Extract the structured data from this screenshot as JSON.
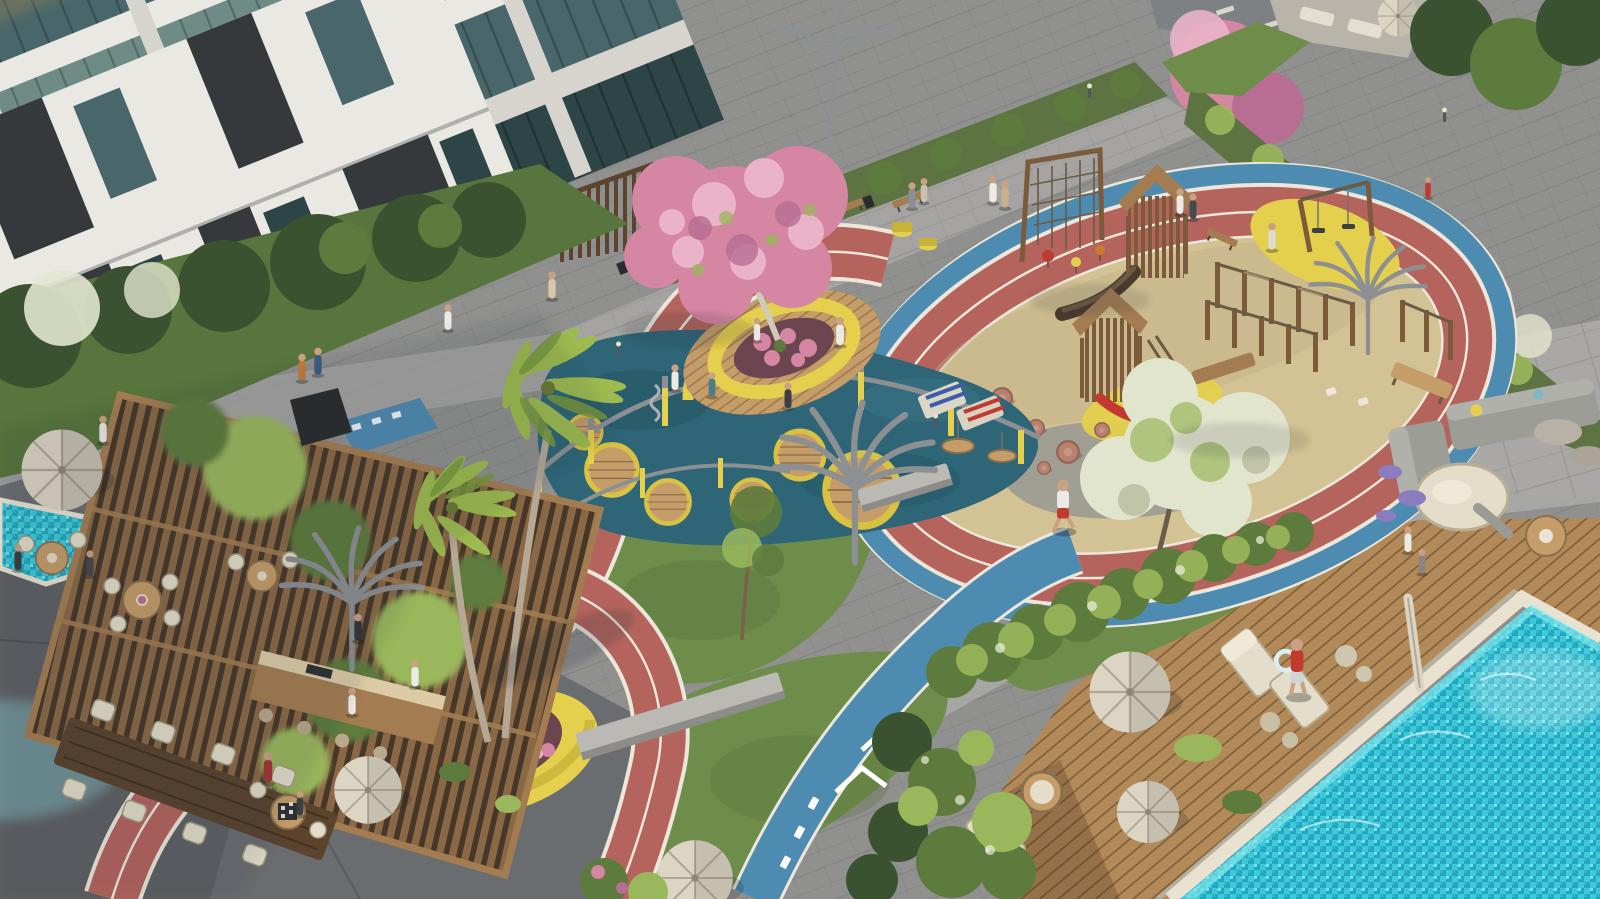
{
  "scene": {
    "type": "photorealistic aerial 3D architectural render",
    "setting": "Residential apartment courtyard amenity deck, daytime",
    "areas": {
      "building_left": "Glass-fronted apartment building at left",
      "building_center": "Apartment building with dark panels at top",
      "building_right": "Apartment building with balconies at right",
      "running_track": "Red two-lane jogging loop with white lane lines",
      "bike_path": "Blue cycle path with white chevrons and dashes",
      "playground_sand": "Sand play area inside the track loop",
      "play_towers": "Wooden play towers with slides",
      "climbing_frames": "Wooden climbing frames and monkey bars",
      "rubber_playground": "Teal rubber play surface with yellow posts, wooden discs and basket swings",
      "blossom_planter": "Round yellow planter with pink blossom tree on timber deck",
      "palm_planter": "Round yellow planter with pink flowers and palm trees",
      "pergola": "Timber pergola with climbing vines",
      "outdoor_kitchen": "Outdoor kitchen bar with stools",
      "cafe_terrace": "Cafe terrace with tables, chairs and parasols",
      "chess_table": "Outdoor chess table",
      "long_table": "Communal timber dining table",
      "swimming_pool": "Turquoise mosaic swimming pool",
      "pool_deck": "Timber pool deck with parasols, loungers and egg chair",
      "lounge_terrace": "Stone lounge terrace with grey sofas and round daybed",
      "shade_structures": "Steel palm-shaped shade structures",
      "walkways": "Grey paver walkways with benches and bollard lights",
      "small_pool": "Water feature at left edge",
      "road": "Street glimpse at top right",
      "breezeway": "Passage under left building with red jogging strip",
      "people": "Residents walking, jogging, playing and relaxing"
    }
  },
  "colors": {
    "paver_light": "#a9a8a6",
    "paver_mid": "#90908f",
    "paver_dark": "#717274",
    "concrete_terrace": "#6a6d70",
    "concrete_shadow": "#53565a",
    "facade_white": "#eae8e3",
    "facade_cream": "#d7d4cd",
    "facade_shadow": "#b7b4ad",
    "facade_dark": "#36393c",
    "glass_dark": "#2e4547",
    "glass_teal": "#49676a",
    "glass_light": "#6e8b85",
    "curtain_teal": "#90b8a8",
    "amber_glow": "#c08a4a",
    "hedge": "#5d7342",
    "grass": "#6e8d4a",
    "grass_dark": "#57753c",
    "foliage_dark": "#3b5230",
    "foliage_mid": "#5d7b3c",
    "foliage_light": "#9ab75c",
    "palm": "#9dbb4f",
    "palm_dark": "#79993c",
    "blossom_pink": "#d586a2",
    "blossom_pink_light": "#eab3c8",
    "blossom_rose": "#b86e92",
    "blossom_white": "#e2e5cd",
    "lavender": "#8b7cbe",
    "track_red": "#b4645c",
    "track_dark": "#9b534e",
    "lane_white": "#ece7da",
    "bike_blue": "#4e8bb1",
    "rubber_teal": "#2e6677",
    "rubber_dark": "#245362",
    "sand": "#d3c294",
    "sand_dark": "#c0af82",
    "rock": "#9b9b93",
    "wood_light": "#c59d69",
    "wood_mid": "#a37d51",
    "wood_dark": "#7b5b3b",
    "wood_deck": "#b28a59",
    "deck_dark": "#8f6c42",
    "pergola_wood": "#8a6845",
    "espresso": "#5b432e",
    "yellow": "#e4d04c",
    "yellow_dark": "#c7b339",
    "pool": "#3fc9d8",
    "pool_deep": "#21a7bf",
    "pool_light": "#93ecf2",
    "pool_edge": "#e9e2d1",
    "umbrella": "#dcd5c3",
    "cushion": "#e3ddca",
    "sofa": "#9c9d97",
    "metal": "#8d9093",
    "charcoal": "#2a2d2f",
    "terracotta": "#b8806f",
    "soil": "#6b4650",
    "skin": "#cba184",
    "red_shirt": "#c13a30",
    "white_shirt": "#eceae4"
  }
}
